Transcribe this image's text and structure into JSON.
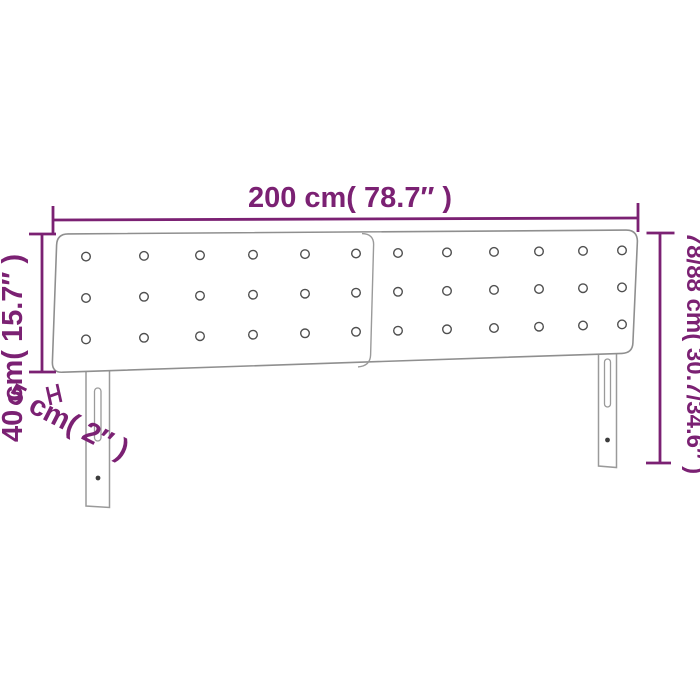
{
  "diagram": {
    "subject": "headboard",
    "labels": {
      "width": "200 cm( 78.7″ )",
      "total_height": "78/88 cm( 30.7/34.6″ )",
      "panel_height": "40 cm( 15.7″ )",
      "panel_thickness": "5 cm( 2″ )"
    },
    "tufting": {
      "panels": 2,
      "columns_per_panel": 6,
      "rows_per_panel": 3
    },
    "colors": {
      "dimension_accent": "#7b2173",
      "furniture_outline": "#8f8f8f",
      "button_outline": "#4f4f4f",
      "background": "#ffffff"
    }
  }
}
